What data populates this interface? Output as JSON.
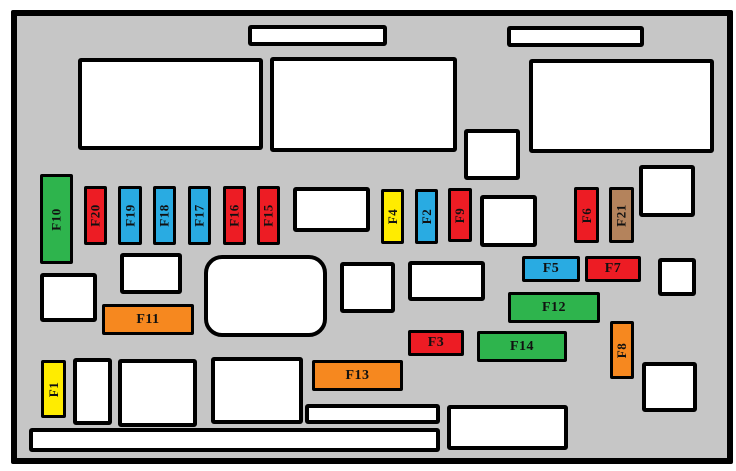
{
  "diagram": {
    "name": "engine-compartment-fuse-box-diagram",
    "panel_background": "#c6c6c6",
    "outline_color": "#000000",
    "slot_fill": "#ffffff",
    "frame": {
      "x": 11,
      "y": 10,
      "w": 722,
      "h": 454
    }
  },
  "colors": {
    "red": "#ed1c24",
    "blue": "#29abe2",
    "green": "#2eb44d",
    "yellow": "#ffec00",
    "orange": "#f6881f",
    "brown": "#b4835c"
  },
  "fuses": [
    {
      "label": "F1",
      "color": "yellow",
      "x": 41,
      "y": 360,
      "w": 25,
      "h": 58,
      "vertical": true
    },
    {
      "label": "F2",
      "color": "blue",
      "x": 415,
      "y": 189,
      "w": 23,
      "h": 55,
      "vertical": true
    },
    {
      "label": "F3",
      "color": "red",
      "x": 408,
      "y": 330,
      "w": 56,
      "h": 26,
      "vertical": false
    },
    {
      "label": "F4",
      "color": "yellow",
      "x": 381,
      "y": 189,
      "w": 23,
      "h": 55,
      "vertical": true
    },
    {
      "label": "F5",
      "color": "blue",
      "x": 522,
      "y": 256,
      "w": 58,
      "h": 26,
      "vertical": false
    },
    {
      "label": "F6",
      "color": "red",
      "x": 574,
      "y": 187,
      "w": 25,
      "h": 56,
      "vertical": true
    },
    {
      "label": "F7",
      "color": "red",
      "x": 585,
      "y": 256,
      "w": 56,
      "h": 26,
      "vertical": false
    },
    {
      "label": "F8",
      "color": "orange",
      "x": 610,
      "y": 321,
      "w": 24,
      "h": 58,
      "vertical": true
    },
    {
      "label": "F9",
      "color": "red",
      "x": 448,
      "y": 188,
      "w": 24,
      "h": 54,
      "vertical": true
    },
    {
      "label": "F10",
      "color": "green",
      "x": 40,
      "y": 174,
      "w": 33,
      "h": 90,
      "vertical": true
    },
    {
      "label": "F11",
      "color": "orange",
      "x": 102,
      "y": 304,
      "w": 92,
      "h": 31,
      "vertical": false
    },
    {
      "label": "F12",
      "color": "green",
      "x": 508,
      "y": 292,
      "w": 92,
      "h": 31,
      "vertical": false
    },
    {
      "label": "F13",
      "color": "orange",
      "x": 312,
      "y": 360,
      "w": 91,
      "h": 31,
      "vertical": false
    },
    {
      "label": "F14",
      "color": "green",
      "x": 477,
      "y": 331,
      "w": 90,
      "h": 31,
      "vertical": false
    },
    {
      "label": "F15",
      "color": "red",
      "x": 257,
      "y": 186,
      "w": 23,
      "h": 59,
      "vertical": true
    },
    {
      "label": "F16",
      "color": "red",
      "x": 223,
      "y": 186,
      "w": 23,
      "h": 59,
      "vertical": true
    },
    {
      "label": "F17",
      "color": "blue",
      "x": 188,
      "y": 186,
      "w": 23,
      "h": 59,
      "vertical": true
    },
    {
      "label": "F18",
      "color": "blue",
      "x": 153,
      "y": 186,
      "w": 23,
      "h": 59,
      "vertical": true
    },
    {
      "label": "F19",
      "color": "blue",
      "x": 118,
      "y": 186,
      "w": 24,
      "h": 59,
      "vertical": true
    },
    {
      "label": "F20",
      "color": "red",
      "x": 84,
      "y": 186,
      "w": 23,
      "h": 59,
      "vertical": true
    },
    {
      "label": "F21",
      "color": "brown",
      "x": 609,
      "y": 187,
      "w": 25,
      "h": 56,
      "vertical": true
    }
  ],
  "boxes": [
    {
      "name": "top-slot-left",
      "x": 248,
      "y": 25,
      "w": 139,
      "h": 21
    },
    {
      "name": "top-slot-right",
      "x": 507,
      "y": 26,
      "w": 137,
      "h": 21
    },
    {
      "name": "relay-box-top-left",
      "x": 78,
      "y": 58,
      "w": 185,
      "h": 92
    },
    {
      "name": "relay-box-top-center",
      "x": 270,
      "y": 57,
      "w": 187,
      "h": 95
    },
    {
      "name": "relay-box-top-right",
      "x": 529,
      "y": 59,
      "w": 185,
      "h": 94
    },
    {
      "name": "relay-square-center",
      "x": 464,
      "y": 129,
      "w": 56,
      "h": 51
    },
    {
      "name": "relay-square-right",
      "x": 639,
      "y": 165,
      "w": 56,
      "h": 52
    },
    {
      "name": "relay-box-fuse-row",
      "x": 293,
      "y": 187,
      "w": 77,
      "h": 45
    },
    {
      "name": "relay-box-right-of-f9",
      "x": 480,
      "y": 195,
      "w": 57,
      "h": 52
    },
    {
      "name": "relay-square-left",
      "x": 40,
      "y": 273,
      "w": 57,
      "h": 49
    },
    {
      "name": "relay-box-above-f11",
      "x": 120,
      "y": 253,
      "w": 62,
      "h": 41
    },
    {
      "name": "rounded-relay-box",
      "x": 204,
      "y": 255,
      "w": 123,
      "h": 82,
      "r": 18
    },
    {
      "name": "relay-box-mid-1",
      "x": 340,
      "y": 262,
      "w": 55,
      "h": 51
    },
    {
      "name": "relay-box-mid-2",
      "x": 408,
      "y": 261,
      "w": 77,
      "h": 40
    },
    {
      "name": "relay-square-right-of-f7",
      "x": 658,
      "y": 258,
      "w": 38,
      "h": 38
    },
    {
      "name": "relay-square-bottom-right",
      "x": 642,
      "y": 362,
      "w": 55,
      "h": 50
    },
    {
      "name": "relay-box-bottom-1",
      "x": 73,
      "y": 358,
      "w": 39,
      "h": 67
    },
    {
      "name": "relay-box-bottom-2",
      "x": 118,
      "y": 359,
      "w": 79,
      "h": 68
    },
    {
      "name": "relay-box-bottom-3",
      "x": 211,
      "y": 357,
      "w": 92,
      "h": 67
    },
    {
      "name": "thin-slot-mid",
      "x": 305,
      "y": 404,
      "w": 135,
      "h": 20
    },
    {
      "name": "relay-box-bottom-4",
      "x": 447,
      "y": 405,
      "w": 121,
      "h": 45
    },
    {
      "name": "long-bottom-slot",
      "x": 29,
      "y": 428,
      "w": 411,
      "h": 24
    }
  ]
}
